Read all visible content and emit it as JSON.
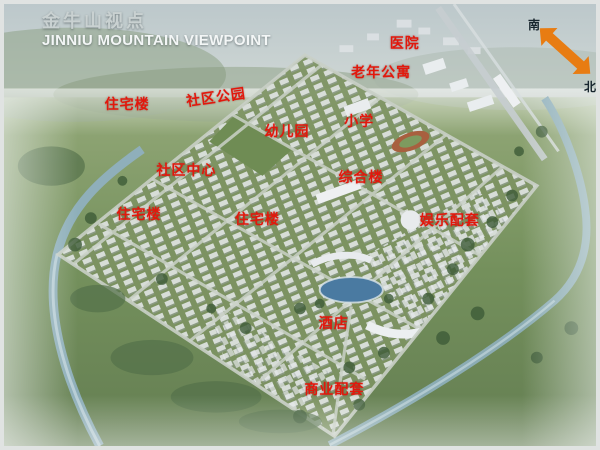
{
  "header": {
    "title_cn": "金牛山视点",
    "title_en": "JINNIU MOUNTAIN VIEWPOINT"
  },
  "compass": {
    "south_label": "南",
    "north_label": "北",
    "arrow_color": "#e87c12"
  },
  "colors": {
    "label_red": "#e2180c",
    "river_blue": "#8fb0bf",
    "lake_blue": "#4a7aa1",
    "field_green": "#74905c"
  },
  "map_labels": [
    {
      "text": "医院",
      "x": 67.7,
      "y": 8.9,
      "rotate": 0
    },
    {
      "text": "老年公寓",
      "x": 63.7,
      "y": 15.3,
      "rotate": 0
    },
    {
      "text": "住宅楼",
      "x": 20.8,
      "y": 22.7,
      "rotate": 0
    },
    {
      "text": "社区公园",
      "x": 35.8,
      "y": 21.1,
      "rotate": -8
    },
    {
      "text": "幼儿园",
      "x": 47.8,
      "y": 28.7,
      "rotate": 0
    },
    {
      "text": "小学",
      "x": 60.0,
      "y": 26.4,
      "rotate": 0
    },
    {
      "text": "社区中心",
      "x": 30.8,
      "y": 37.6,
      "rotate": 0
    },
    {
      "text": "综合楼",
      "x": 60.3,
      "y": 39.1,
      "rotate": 0
    },
    {
      "text": "住宅楼",
      "x": 22.8,
      "y": 47.6,
      "rotate": 0
    },
    {
      "text": "住宅楼",
      "x": 42.8,
      "y": 48.7,
      "rotate": 0
    },
    {
      "text": "娱乐配套",
      "x": 75.3,
      "y": 48.9,
      "rotate": 0
    },
    {
      "text": "酒店",
      "x": 55.7,
      "y": 72.2,
      "rotate": 0
    },
    {
      "text": "商业配套",
      "x": 55.8,
      "y": 87.1,
      "rotate": 0
    }
  ]
}
